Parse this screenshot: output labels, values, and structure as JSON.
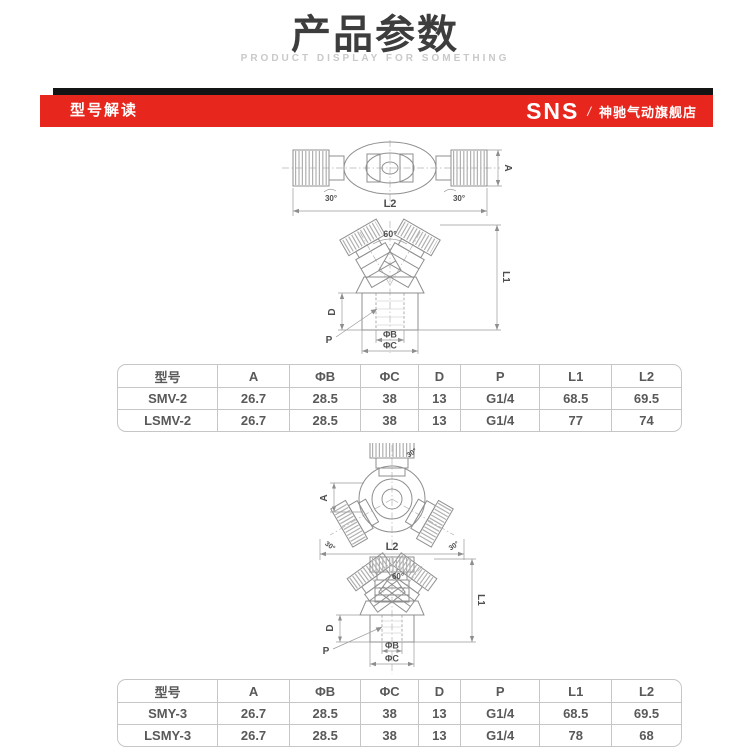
{
  "page": {
    "title": "产品参数",
    "subtitle": "PRODUCT DISPLAY FOR SOMETHING"
  },
  "header": {
    "section_title": "型号解读",
    "brand": "SNS",
    "separator": "/",
    "store_name": "神驰气动旗舰店",
    "bar_color": "#e7261d",
    "stripe_color": "#141414"
  },
  "diagram1": {
    "labels": {
      "a": "A",
      "l2": "L2",
      "l1": "L1",
      "d": "D",
      "p": "P",
      "phi_b": "ΦB",
      "phi_c": "ΦC",
      "angle60": "60°",
      "angle30_left": "30°",
      "angle30_right": "30°"
    }
  },
  "diagram2": {
    "labels": {
      "a": "A",
      "l2": "L2",
      "l1": "L1",
      "d": "D",
      "p": "P",
      "phi_b": "ΦB",
      "phi_c": "ΦC",
      "angle60": "60°",
      "angle30_top": "30°",
      "angle30_left": "30°",
      "angle30_right": "30°"
    }
  },
  "table1": {
    "headers": [
      "型号",
      "A",
      "ΦB",
      "ΦC",
      "D",
      "P",
      "L1",
      "L2"
    ],
    "rows": [
      [
        "SMV-2",
        "26.7",
        "28.5",
        "38",
        "13",
        "G1/4",
        "68.5",
        "69.5"
      ],
      [
        "LSMV-2",
        "26.7",
        "28.5",
        "38",
        "13",
        "G1/4",
        "77",
        "74"
      ]
    ]
  },
  "table2": {
    "headers": [
      "型号",
      "A",
      "ΦB",
      "ΦC",
      "D",
      "P",
      "L1",
      "L2"
    ],
    "rows": [
      [
        "SMY-3",
        "26.7",
        "28.5",
        "38",
        "13",
        "G1/4",
        "68.5",
        "69.5"
      ],
      [
        "LSMY-3",
        "26.7",
        "28.5",
        "38",
        "13",
        "G1/4",
        "78",
        "68"
      ]
    ]
  }
}
